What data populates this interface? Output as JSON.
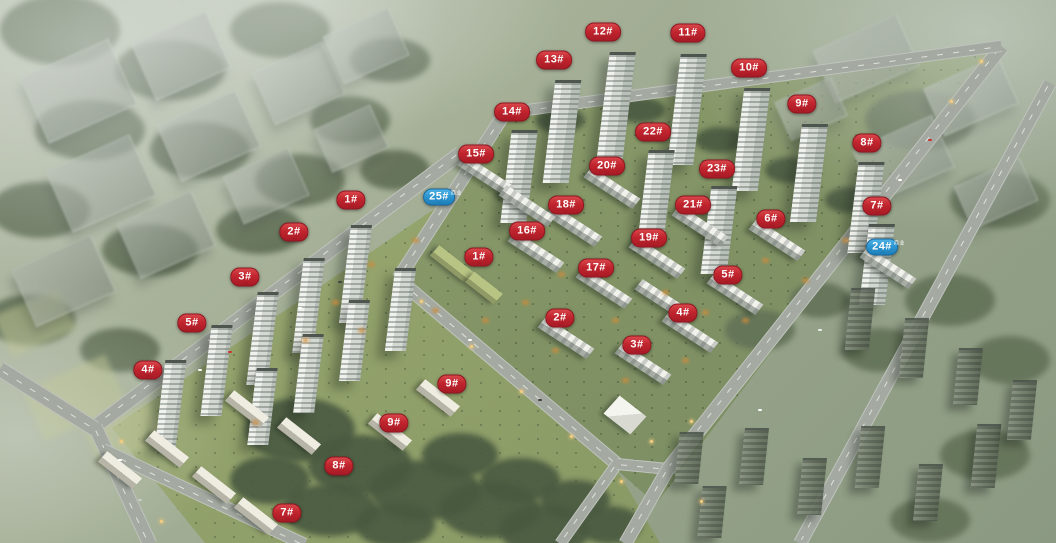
{
  "badge_colors": {
    "red": "#c1242d",
    "blue": "#2b94cf"
  },
  "building_labels": [
    {
      "text": "12#",
      "type": "red",
      "x": 603,
      "y": 32
    },
    {
      "text": "11#",
      "type": "red",
      "x": 688,
      "y": 33
    },
    {
      "text": "13#",
      "type": "red",
      "x": 554,
      "y": 60
    },
    {
      "text": "10#",
      "type": "red",
      "x": 749,
      "y": 68
    },
    {
      "text": "9#",
      "type": "red",
      "x": 802,
      "y": 104
    },
    {
      "text": "14#",
      "type": "red",
      "x": 512,
      "y": 112
    },
    {
      "text": "22#",
      "type": "red",
      "x": 653,
      "y": 132
    },
    {
      "text": "8#",
      "type": "red",
      "x": 867,
      "y": 143
    },
    {
      "text": "15#",
      "type": "red",
      "x": 476,
      "y": 154
    },
    {
      "text": "20#",
      "type": "red",
      "x": 607,
      "y": 166
    },
    {
      "text": "23#",
      "type": "red",
      "x": 717,
      "y": 169
    },
    {
      "text": "25#",
      "type": "blue",
      "x": 439,
      "y": 197,
      "sub": "商业"
    },
    {
      "text": "1#",
      "type": "red",
      "x": 351,
      "y": 200
    },
    {
      "text": "18#",
      "type": "red",
      "x": 566,
      "y": 205
    },
    {
      "text": "21#",
      "type": "red",
      "x": 693,
      "y": 205
    },
    {
      "text": "7#",
      "type": "red",
      "x": 877,
      "y": 206
    },
    {
      "text": "6#",
      "type": "red",
      "x": 771,
      "y": 219
    },
    {
      "text": "16#",
      "type": "red",
      "x": 527,
      "y": 231
    },
    {
      "text": "2#",
      "type": "red",
      "x": 294,
      "y": 232
    },
    {
      "text": "19#",
      "type": "red",
      "x": 649,
      "y": 238
    },
    {
      "text": "24#",
      "type": "blue",
      "x": 882,
      "y": 247,
      "sub": "商业"
    },
    {
      "text": "1#",
      "type": "red",
      "x": 479,
      "y": 257
    },
    {
      "text": "17#",
      "type": "red",
      "x": 596,
      "y": 268
    },
    {
      "text": "5#",
      "type": "red",
      "x": 728,
      "y": 275
    },
    {
      "text": "3#",
      "type": "red",
      "x": 245,
      "y": 277
    },
    {
      "text": "4#",
      "type": "red",
      "x": 683,
      "y": 313
    },
    {
      "text": "2#",
      "type": "red",
      "x": 560,
      "y": 318
    },
    {
      "text": "5#",
      "type": "red",
      "x": 192,
      "y": 323
    },
    {
      "text": "3#",
      "type": "red",
      "x": 637,
      "y": 345
    },
    {
      "text": "4#",
      "type": "red",
      "x": 148,
      "y": 370
    },
    {
      "text": "9#",
      "type": "red",
      "x": 452,
      "y": 384
    },
    {
      "text": "9#",
      "type": "red",
      "x": 394,
      "y": 423
    },
    {
      "text": "8#",
      "type": "red",
      "x": 339,
      "y": 466
    },
    {
      "text": "7#",
      "type": "red",
      "x": 287,
      "y": 513
    }
  ]
}
